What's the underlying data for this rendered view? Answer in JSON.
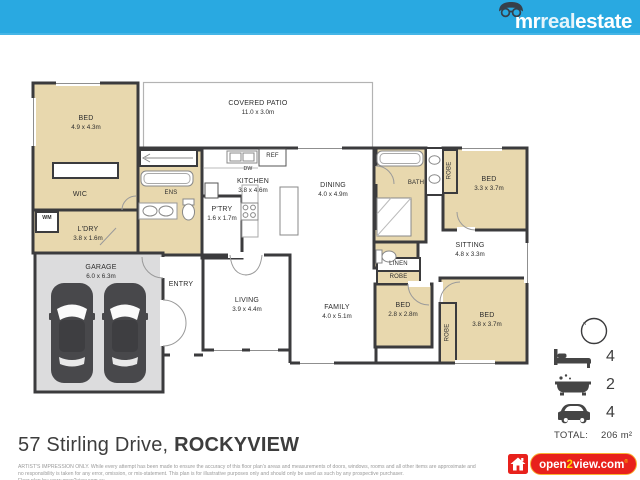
{
  "brand": {
    "mr": "mr",
    "real": "real",
    "estate": "estate"
  },
  "plan": {
    "patio": {
      "name": "COVERED PATIO",
      "dims": "11.0 x 3.0m"
    },
    "bed1": {
      "name": "BED",
      "dims": "4.9 x 4.3m"
    },
    "wic": "WIC",
    "wm": "WM",
    "ldry": {
      "name": "L'DRY",
      "dims": "3.8 x 1.6m"
    },
    "garage": {
      "name": "GARAGE",
      "dims": "6.0 x 6.3m"
    },
    "entry": "ENTRY",
    "ens": "ENS",
    "ptry": {
      "name": "P'TRY",
      "dims": "1.6 x 1.7m"
    },
    "kitchen": {
      "name": "KITCHEN",
      "dims": "3.8 x 4.6m"
    },
    "ref": "REF",
    "dw": "DW",
    "dining": {
      "name": "DINING",
      "dims": "4.0 x 4.9m"
    },
    "living": {
      "name": "LIVING",
      "dims": "3.9 x 4.4m"
    },
    "family": {
      "name": "FAMILY",
      "dims": "4.0 x 5.1m"
    },
    "bath": "BATH",
    "robe1": "ROBE",
    "bed2": {
      "name": "BED",
      "dims": "3.3 x 3.7m"
    },
    "sitting": {
      "name": "SITTING",
      "dims": "4.8 x 3.3m"
    },
    "linen": "LINEN",
    "robe2": "ROBE",
    "bed3": {
      "name": "BED",
      "dims": "2.8 x 2.8m"
    },
    "robe3": "ROBE",
    "bed4": {
      "name": "BED",
      "dims": "3.8 x 3.7m"
    },
    "compass_n": "N"
  },
  "legend": {
    "beds": "4",
    "baths": "2",
    "cars": "4",
    "total_label": "TOTAL:",
    "total_value": "206 m²"
  },
  "footer": {
    "address_street": "57 Stirling Drive, ",
    "address_suburb": "ROCKYVIEW",
    "disclaimer": "ARTIST'S IMPRESSION ONLY. While every attempt has been made to ensure the accuracy of this floor plan's areas and measurements of doors, windows, rooms and all other items are approximate and no responsibility is taken for any error, omission, or mis-statement. This plan is for illustrative purposes only and should only be used as such by any prospective purchaser.",
    "credit": "Floor plan by: www.open2view.com.au"
  },
  "open2view": {
    "open": "open",
    "two": "2",
    "view": "view.com",
    "reg": "®"
  },
  "colors": {
    "topbar": "#29a9e1",
    "room_tan": "#e8d8ae",
    "garage_fill": "#dcdcdd",
    "wall": "#3b3b3d",
    "logo_red": "#e8211c",
    "logo_yellow": "#f9b233"
  }
}
